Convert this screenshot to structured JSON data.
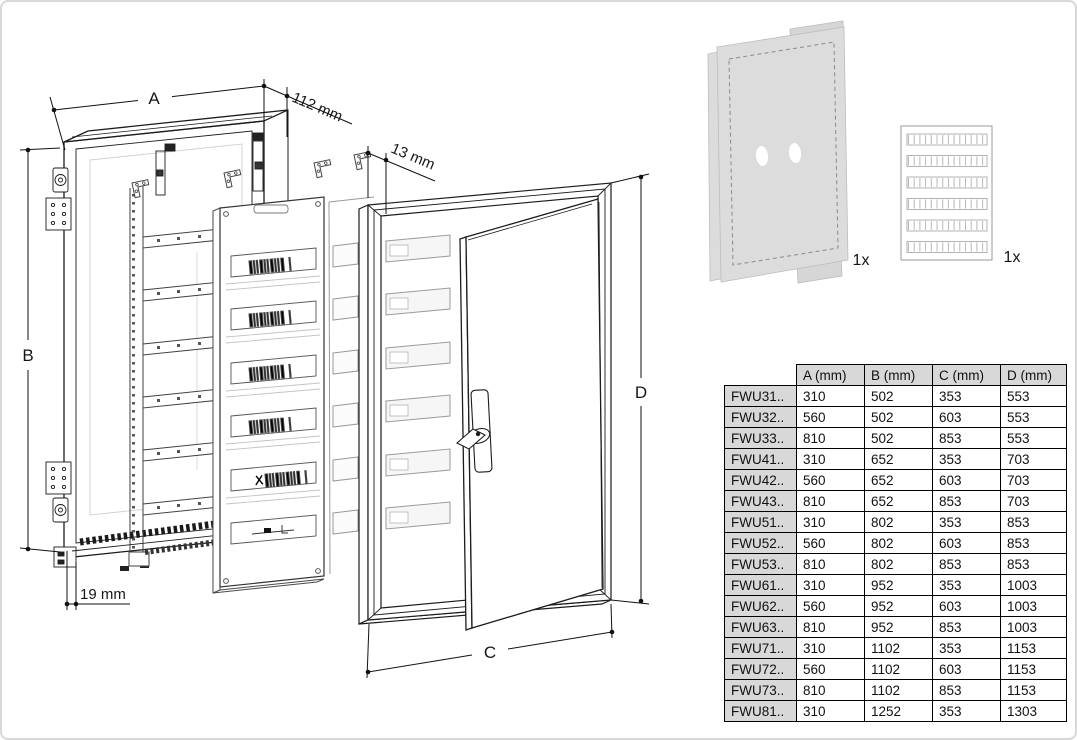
{
  "drawing": {
    "labels": {
      "width": "A",
      "height": "B",
      "door_width": "C",
      "door_height": "D",
      "depth": "112 mm",
      "door_projection": "13 mm",
      "bottom_offset": "19 mm"
    }
  },
  "accessories": {
    "protective_foil_qty": "1x",
    "label_sheet_qty": "1x"
  },
  "table": {
    "columns": [
      "A (mm)",
      "B (mm)",
      "C (mm)",
      "D (mm)"
    ],
    "rows": [
      {
        "model": "FWU31..",
        "a": "310",
        "b": "502",
        "c": "353",
        "d": "553"
      },
      {
        "model": "FWU32..",
        "a": "560",
        "b": "502",
        "c": "603",
        "d": "553"
      },
      {
        "model": "FWU33..",
        "a": "810",
        "b": "502",
        "c": "853",
        "d": "553"
      },
      {
        "model": "FWU41..",
        "a": "310",
        "b": "652",
        "c": "353",
        "d": "703"
      },
      {
        "model": "FWU42..",
        "a": "560",
        "b": "652",
        "c": "603",
        "d": "703"
      },
      {
        "model": "FWU43..",
        "a": "810",
        "b": "652",
        "c": "853",
        "d": "703"
      },
      {
        "model": "FWU51..",
        "a": "310",
        "b": "802",
        "c": "353",
        "d": "853"
      },
      {
        "model": "FWU52..",
        "a": "560",
        "b": "802",
        "c": "603",
        "d": "853"
      },
      {
        "model": "FWU53..",
        "a": "810",
        "b": "802",
        "c": "853",
        "d": "853"
      },
      {
        "model": "FWU61..",
        "a": "310",
        "b": "952",
        "c": "353",
        "d": "1003"
      },
      {
        "model": "FWU62..",
        "a": "560",
        "b": "952",
        "c": "603",
        "d": "1003"
      },
      {
        "model": "FWU63..",
        "a": "810",
        "b": "952",
        "c": "853",
        "d": "1003"
      },
      {
        "model": "FWU71..",
        "a": "310",
        "b": "1102",
        "c": "353",
        "d": "1153"
      },
      {
        "model": "FWU72..",
        "a": "560",
        "b": "1102",
        "c": "603",
        "d": "1153"
      },
      {
        "model": "FWU73..",
        "a": "810",
        "b": "1102",
        "c": "853",
        "d": "1153"
      },
      {
        "model": "FWU81..",
        "a": "310",
        "b": "1252",
        "c": "353",
        "d": "1303"
      }
    ]
  },
  "colors": {
    "table_header_bg": "#d8d8d8",
    "table_border": "#000000",
    "line_art": "#1c1c1c",
    "light_line": "#9a9a9a",
    "foil_fill": "#dcdcdc",
    "page_border": "#d8d8d8"
  }
}
